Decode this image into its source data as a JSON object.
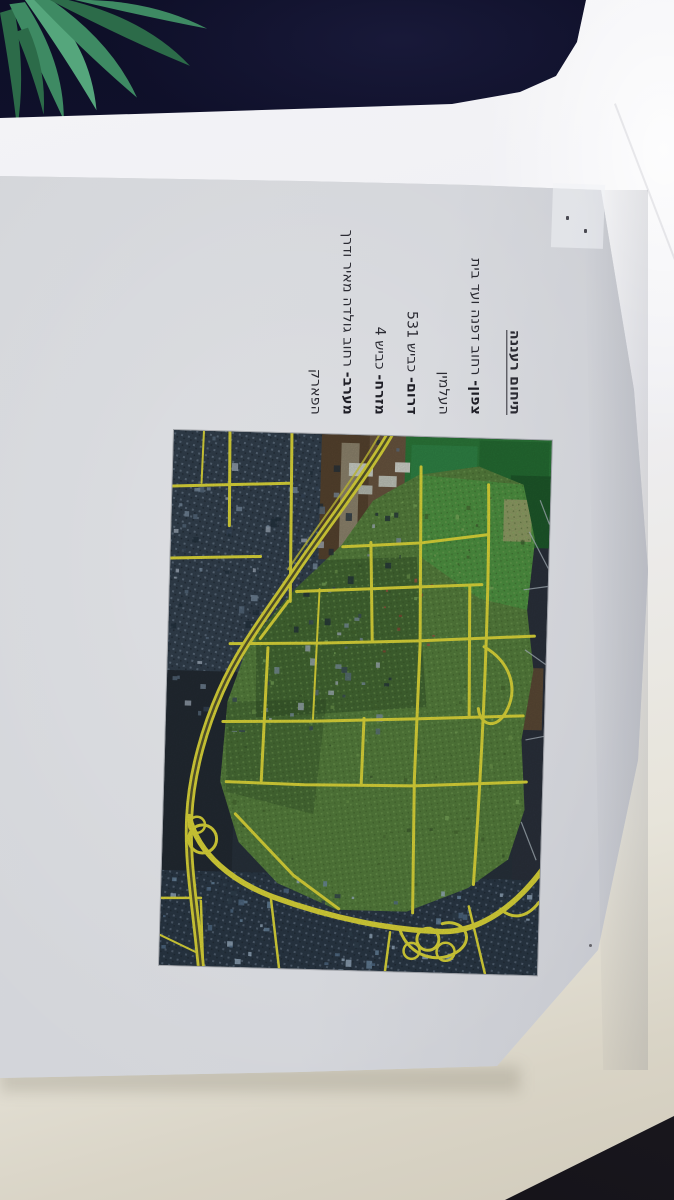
{
  "document": {
    "title": "תיחום רעננה",
    "lines": [
      {
        "lead": "צפון-",
        "rest": " רחוב דפנה ועד בית"
      },
      {
        "lead": "",
        "rest": "העלמין"
      },
      {
        "lead": "דרום-",
        "rest": " כביש 531"
      },
      {
        "lead": "מזרח-",
        "rest": " כביש 4"
      },
      {
        "lead": "מערב-",
        "rest": " רחוב גולדה מאיר ודרך"
      },
      {
        "lead": "",
        "rest": "הפארק"
      }
    ]
  },
  "map": {
    "kind": "aerial-photo-with-highlighted-roads",
    "colors": {
      "roadYellow": "#e3dd3b",
      "roadCenter": "#5a5930",
      "cityGreen": "#57813e",
      "fieldGreen": "#2c7a3a",
      "brightField": "#4f9a44",
      "urbanBlue": "#33414f",
      "urbanDark": "#232b33",
      "bottomUrban": "#2b3947",
      "brownField": "#57442f",
      "buildingBlue": "#6e8ca6",
      "paleRoad": "#aebac2",
      "cityShadow": "#2c4724"
    }
  },
  "scene": {
    "colors": {
      "fabric": "#121330",
      "plant": "#3e8a63",
      "plantDark": "#2c6b49",
      "plantLight": "#55a67c",
      "printedPage": "#d2d4d9",
      "ink": "#2b2b33",
      "tableDark": "#1c1a21"
    }
  }
}
